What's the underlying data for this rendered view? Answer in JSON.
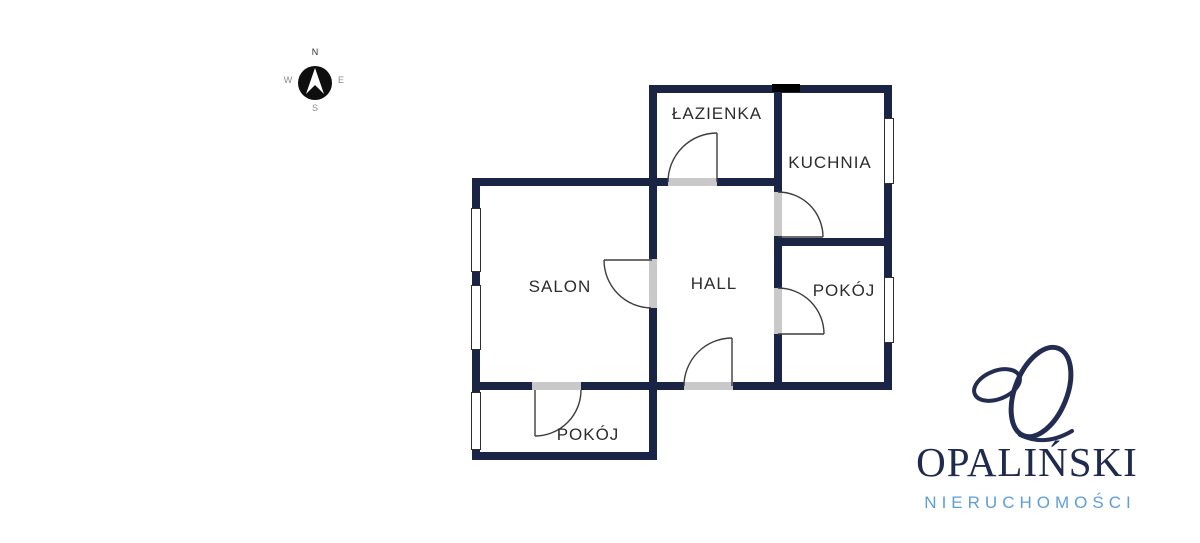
{
  "canvas": {
    "width": 1200,
    "height": 543,
    "background": "#ffffff"
  },
  "compass": {
    "north": "N",
    "east": "E",
    "south": "S",
    "west": "W"
  },
  "floor_plan": {
    "rooms": [
      {
        "id": "lazienka",
        "label": "ŁAZIENKA"
      },
      {
        "id": "kuchnia",
        "label": "KUCHNIA"
      },
      {
        "id": "salon",
        "label": "SALON"
      },
      {
        "id": "hall",
        "label": "HALL"
      },
      {
        "id": "pokoj-right",
        "label": "POKÓJ"
      },
      {
        "id": "pokoj-bottom",
        "label": "POKÓJ"
      }
    ],
    "counts": {
      "windows": 5,
      "door_openings": 6
    },
    "colors": {
      "wall": "#1a2445",
      "door_opening": "#c9c9c9",
      "door_swing": "#3d3d3d",
      "window_fill": "#ffffff",
      "window_border": "#2e2e2e",
      "label_text": "#2d2d2d"
    }
  },
  "branding": {
    "company_name": "OPALIŃSKI",
    "company_tagline": "NIERUCHOMOŚCI",
    "monogram": "script-o-monogram",
    "name_color": "#1f2a4e",
    "tagline_color": "#5e9ed7",
    "monogram_color": "#232d52"
  }
}
